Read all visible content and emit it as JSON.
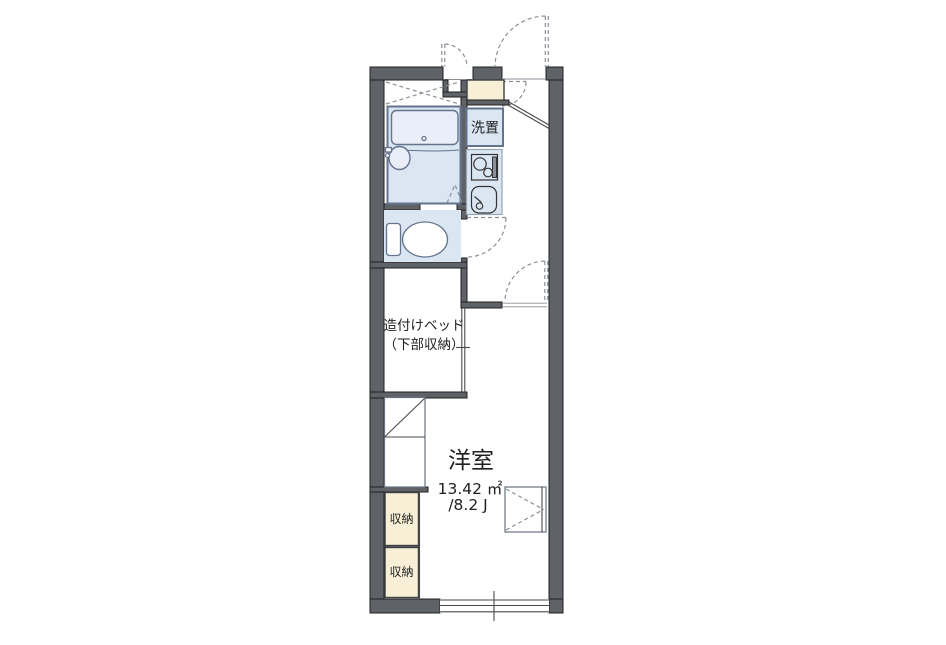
{
  "title": "apartment-floor-plan",
  "colors": {
    "wall": "#5f6368",
    "wall-stroke": "#1f1f1f",
    "room-blue": "#dbe6f3",
    "fixture-blue": "#e9eef8",
    "blue-border": "#64748f",
    "cream": "#f8efd7",
    "dash": "#8a9099",
    "line": "#4a4a4a",
    "text": "#1f1f1f"
  },
  "labels": {
    "laundry": "洗置",
    "bed_line1": "造付けベッド",
    "bed_line2": "（下部収納）",
    "storage_upper": "収納",
    "storage_lower": "収納",
    "room_name": "洋室",
    "room_area_m2": "13.42 ㎡",
    "room_area_jo": "/8.2 J"
  }
}
